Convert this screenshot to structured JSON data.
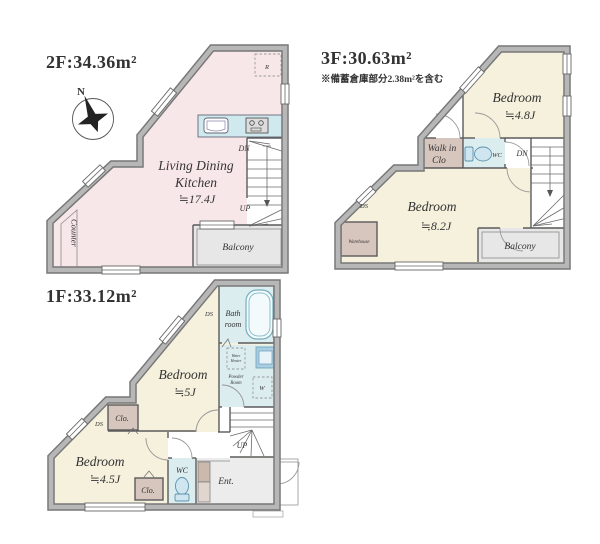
{
  "colors": {
    "wall-dark": "#777777",
    "wall-light": "#b7b7b7",
    "text": "#333333",
    "ldk": "#f8e7e9",
    "bedroom": "#f6f1dd",
    "closet": "#d7c6bd",
    "water": "#dcedf0",
    "counter-top": "#cfe9ee",
    "vanity": "#a9cde2",
    "balcony": "#e7e7e7",
    "entrance": "#ececec"
  },
  "floors": {
    "f2": {
      "title": "2F:34.36m²",
      "room_ldk_1": "Living Dining",
      "room_ldk_2": "Kitchen",
      "room_ldk_size": "≒17.4J",
      "counter": "Counter",
      "balcony": "Balcony",
      "fridge": "R",
      "stair_dn": "DN",
      "stair_up": "UP",
      "compass_n": "N"
    },
    "f3": {
      "title": "3F:30.63m²",
      "note": "※備蓄倉庫部分2.38m²を含む",
      "bedroom_a": "Bedroom",
      "bedroom_a_size": "≒4.8J",
      "bedroom_b": "Bedroom",
      "bedroom_b_size": "≒8.2J",
      "walkin_1": "Walk in",
      "walkin_2": "Clo",
      "wc": "WC",
      "warehouse": "Warehouse",
      "balcony": "Balcony",
      "stair_dn": "DN",
      "duct": "DS"
    },
    "f1": {
      "title": "1F:33.12m²",
      "bedroom_a": "Bedroom",
      "bedroom_a_size": "≒5J",
      "bedroom_b": "Bedroom",
      "bedroom_b_size": "≒4.5J",
      "bath_1": "Bath",
      "bath_2": "room",
      "powder_1": "Powder",
      "powder_2": "Room",
      "heater_1": "Water",
      "heater_2": "Heater",
      "washer": "W",
      "wc": "WC",
      "entrance": "Ent.",
      "closet_a": "Clo.",
      "closet_b": "Clo.",
      "stair_up": "UP",
      "duct_a": "DS",
      "duct_b": "DS"
    }
  }
}
